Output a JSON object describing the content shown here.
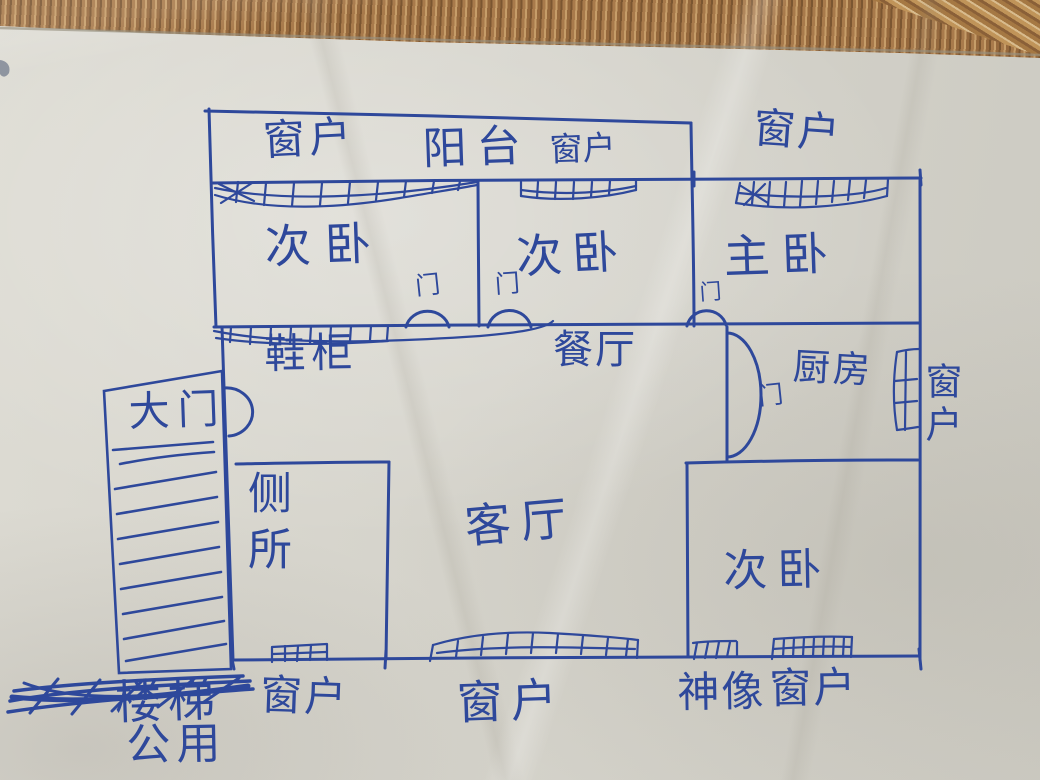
{
  "colors": {
    "ink": "#2e489b",
    "paper": "#d9d7ce",
    "mat_brown": "#a87a4b"
  },
  "plan": {
    "rooms": {
      "bedroom_top_left": "次卧",
      "bedroom_top_middle": "次卧",
      "master_bedroom": "主卧",
      "bedroom_bottom_right": "次卧",
      "dining_room": "餐厅",
      "kitchen": "厨房",
      "living_room": "客厅",
      "toilet": "侧所",
      "balcony": "阳台"
    },
    "features": {
      "shoe_cabinet": "鞋柜",
      "main_gate": "大门",
      "shrine": "神像",
      "stairs": "楼梯",
      "stairs_shared": "公用"
    },
    "windows": {
      "top_left": "窗户",
      "top_middle": "窗户",
      "top_right": "窗户",
      "kitchen_right": "窗户",
      "toilet_bottom": "窗户",
      "living_bottom": "窗户",
      "bedroom_bottom": "窗户"
    },
    "doors": {
      "bedroom_top_left": "门",
      "bedroom_top_middle": "门",
      "master_bedroom": "门",
      "kitchen": "门"
    }
  }
}
